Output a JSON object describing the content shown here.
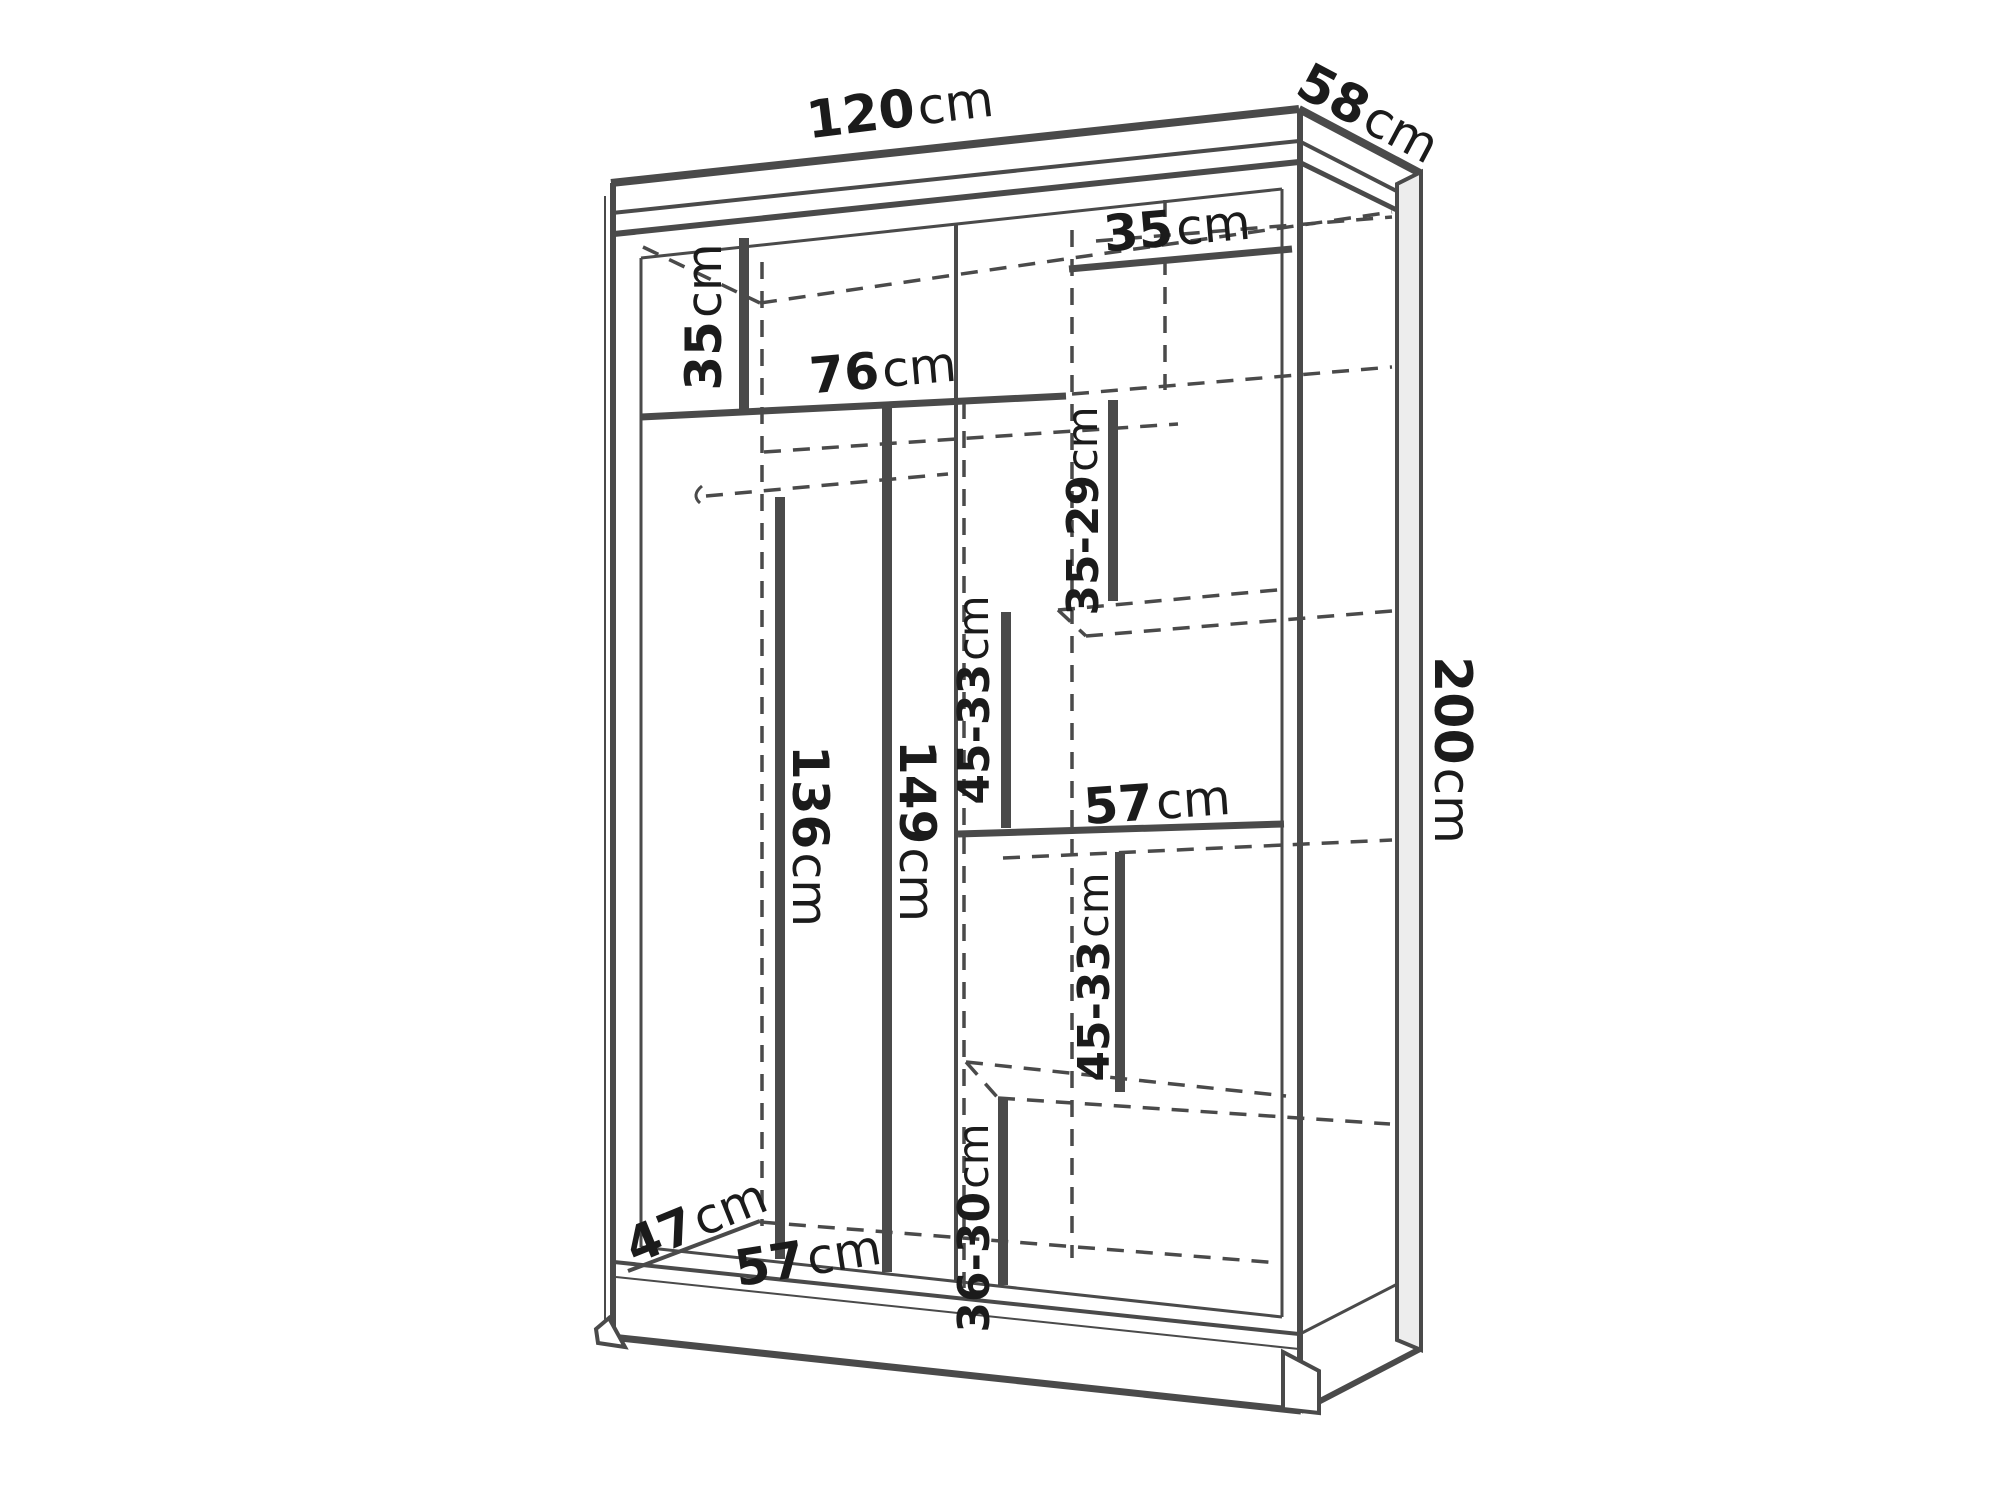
{
  "diagram": {
    "type": "furniture-dimension-diagram",
    "subject": "sliding-door wardrobe with shelves and hanging rail",
    "unit": "cm",
    "overall_dimensions": {
      "width": "120cm",
      "depth": "58cm",
      "height": "200cm"
    },
    "internal_dimensions": [
      "35cm",
      "35cm",
      "76cm",
      "35-29cm",
      "45-33cm",
      "57cm",
      "136cm",
      "149cm",
      "45-33cm",
      "36-30cm",
      "57cm",
      "47cm"
    ],
    "labels": [
      {
        "id": "overall-width",
        "value": "120",
        "unit": "cm",
        "x": 900,
        "y": 110,
        "rotate": -7,
        "size": 52
      },
      {
        "id": "overall-depth",
        "value": "58",
        "unit": "cm",
        "x": 1368,
        "y": 114,
        "rotate": 28,
        "size": 52
      },
      {
        "id": "overall-height",
        "value": "200",
        "unit": "cm",
        "x": 1452,
        "y": 750,
        "rotate": 90,
        "size": 52
      },
      {
        "id": "top-left-compartment-height",
        "value": "35",
        "unit": "cm",
        "x": 704,
        "y": 317,
        "rotate": -90,
        "size": 50
      },
      {
        "id": "left-section-width",
        "value": "76",
        "unit": "cm",
        "x": 883,
        "y": 370,
        "rotate": -5,
        "size": 50
      },
      {
        "id": "top-right-compartment-height",
        "value": "35",
        "unit": "cm",
        "x": 1177,
        "y": 228,
        "rotate": -5,
        "size": 50
      },
      {
        "id": "right-upper-compartment-height",
        "value": "35-29",
        "unit": "cm",
        "x": 1083,
        "y": 511,
        "rotate": -90,
        "size": 44
      },
      {
        "id": "right-middle-upper-compartment-height",
        "value": "45-33",
        "unit": "cm",
        "x": 974,
        "y": 700,
        "rotate": -90,
        "size": 44
      },
      {
        "id": "right-shelf-width",
        "value": "57",
        "unit": "cm",
        "x": 1157,
        "y": 802,
        "rotate": -4,
        "size": 50
      },
      {
        "id": "left-hanging-height",
        "value": "136",
        "unit": "cm",
        "x": 810,
        "y": 836,
        "rotate": 90,
        "size": 50
      },
      {
        "id": "left-interior-height",
        "value": "149",
        "unit": "cm",
        "x": 917,
        "y": 831,
        "rotate": 90,
        "size": 50
      },
      {
        "id": "right-middle-lower-compartment-height",
        "value": "45-33",
        "unit": "cm",
        "x": 1094,
        "y": 977,
        "rotate": -90,
        "size": 44
      },
      {
        "id": "right-bottom-compartment-height",
        "value": "36-30",
        "unit": "cm",
        "x": 974,
        "y": 1228,
        "rotate": -90,
        "size": 44
      },
      {
        "id": "bottom-shelf-width",
        "value": "57",
        "unit": "cm",
        "x": 808,
        "y": 1258,
        "rotate": -9,
        "size": 50
      },
      {
        "id": "interior-depth",
        "value": "47",
        "unit": "cm",
        "x": 696,
        "y": 1221,
        "rotate": -22,
        "size": 50
      }
    ],
    "colors": {
      "line": "#4a4a4a",
      "label": "#1b1b1b",
      "panel_fill": "#ededed",
      "background": "#ffffff"
    }
  }
}
